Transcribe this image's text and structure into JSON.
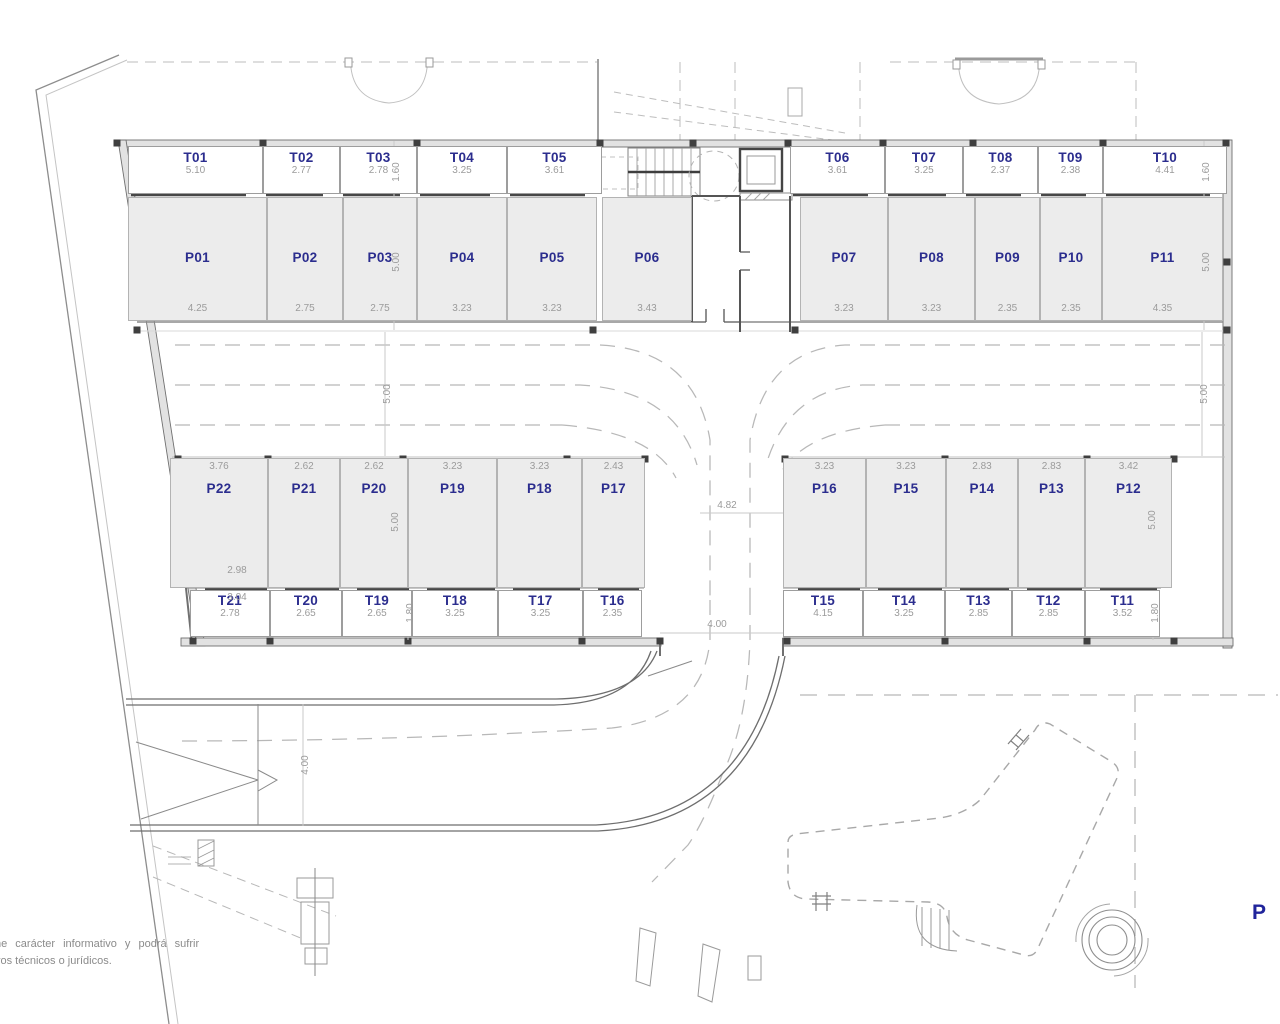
{
  "meta": {
    "plan_letter": "P",
    "disclaimer_line1": "ne carácter informativo y podrá sufrir",
    "disclaimer_line2": "vos técnicos o jurídicos."
  },
  "colors": {
    "label_blue": "#2b2d8e",
    "dimension_gray": "#9b9b9b",
    "parking_fill": "#ececec",
    "wall_gray": "#6e6e6e",
    "dash_gray": "#b8b8b8"
  },
  "rooms": {
    "top_storage": [
      {
        "id": "T01",
        "dim": "5.10"
      },
      {
        "id": "T02",
        "dim": "2.77"
      },
      {
        "id": "T03",
        "dim": "2.78"
      },
      {
        "id": "T04",
        "dim": "3.25"
      },
      {
        "id": "T05",
        "dim": "3.61"
      },
      {
        "id": "T06",
        "dim": "3.61"
      },
      {
        "id": "T07",
        "dim": "3.25"
      },
      {
        "id": "T08",
        "dim": "2.37"
      },
      {
        "id": "T09",
        "dim": "2.38"
      },
      {
        "id": "T10",
        "dim": "4.41"
      }
    ],
    "top_parking": [
      {
        "id": "P01",
        "dim": "4.25"
      },
      {
        "id": "P02",
        "dim": "2.75"
      },
      {
        "id": "P03",
        "dim": "2.75"
      },
      {
        "id": "P04",
        "dim": "3.23"
      },
      {
        "id": "P05",
        "dim": "3.23"
      },
      {
        "id": "P06",
        "dim": "3.43"
      },
      {
        "id": "P07",
        "dim": "3.23"
      },
      {
        "id": "P08",
        "dim": "3.23"
      },
      {
        "id": "P09",
        "dim": "2.35"
      },
      {
        "id": "P10",
        "dim": "2.35"
      },
      {
        "id": "P11",
        "dim": "4.35"
      }
    ],
    "bottom_parking": [
      {
        "id": "P22",
        "dim": "3.76"
      },
      {
        "id": "P21",
        "dim": "2.62"
      },
      {
        "id": "P20",
        "dim": "2.62"
      },
      {
        "id": "P19",
        "dim": "3.23"
      },
      {
        "id": "P18",
        "dim": "3.23"
      },
      {
        "id": "P17",
        "dim": "2.43"
      },
      {
        "id": "P16",
        "dim": "3.23"
      },
      {
        "id": "P15",
        "dim": "3.23"
      },
      {
        "id": "P14",
        "dim": "2.83"
      },
      {
        "id": "P13",
        "dim": "2.83"
      },
      {
        "id": "P12",
        "dim": "3.42"
      }
    ],
    "bottom_storage": [
      {
        "id": "T21",
        "dim": "2.78"
      },
      {
        "id": "T20",
        "dim": "2.65"
      },
      {
        "id": "T19",
        "dim": "2.65"
      },
      {
        "id": "T18",
        "dim": "3.25"
      },
      {
        "id": "T17",
        "dim": "3.25"
      },
      {
        "id": "T16",
        "dim": "2.35"
      },
      {
        "id": "T15",
        "dim": "4.15"
      },
      {
        "id": "T14",
        "dim": "3.25"
      },
      {
        "id": "T13",
        "dim": "2.85"
      },
      {
        "id": "T12",
        "dim": "2.85"
      },
      {
        "id": "T11",
        "dim": "3.52"
      }
    ]
  },
  "vertical_dims": [
    "1.60",
    "5.00",
    "1.60",
    "5.00",
    "5.00",
    "5.00",
    "5.00",
    "5.00",
    "1.80",
    "1.80",
    "4.00"
  ],
  "extra_dims": [
    "2.98",
    "3.04",
    "4.82",
    "4.00"
  ]
}
